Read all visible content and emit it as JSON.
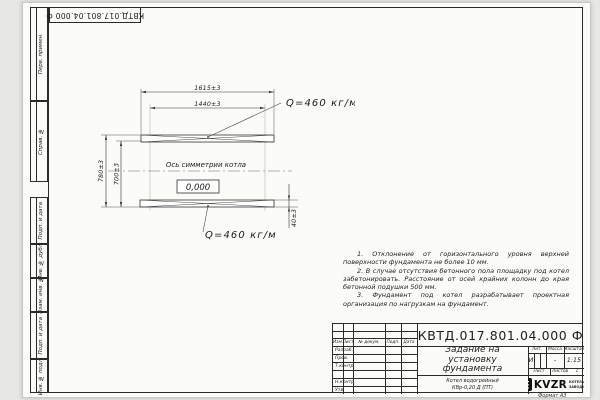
{
  "doc_number": "КВТД.017.801.04.000 Ф",
  "format_label": "Формат А3",
  "colors": {
    "line": "#2b2b2b",
    "sheet": "#fbfbf8",
    "canvas": "#e7e7e4",
    "logo_black": "#101010"
  },
  "margin": {
    "perv_primen": "Перв. примен.",
    "sprav_no": "Справ. №",
    "podp_data_1": "Подп. и дата",
    "inv_dubl": "Инв. № дубл.",
    "vzam_inv": "Взам. инв. №",
    "podp_data_2": "Подп. и дата",
    "inv_podl": "Инв. № подл."
  },
  "drawing": {
    "dim_1615": "1615±3",
    "dim_1440": "1440±3",
    "dim_780": "780±3",
    "dim_700": "700±3",
    "dim_40": "40±3",
    "load_top": "Q=460 кг/м",
    "load_bottom": "Q=460 кг/м",
    "axis_label": "Ось симметрии котла",
    "elevation": "0,000"
  },
  "notes": [
    "1. Отклонение от горизонтального уровня верхней поверхности фундамента не более 10 мм.",
    "2. В случае отсутствия бетонного пола площадку под котел забетонировать. Расстояние от осей крайних колонн до края бетонной подушки 500 мм.",
    "3. Фундамент под котел разрабатывает проектная организация по нагрузкам на фундамент."
  ],
  "title_block": {
    "title_line1": "Задание на",
    "title_line2": "установку",
    "title_line3": "фундамента",
    "header_izm": "Изм.",
    "header_list": "Лист",
    "header_doc": "№ докум.",
    "header_podp": "Подп.",
    "header_data": "Дата",
    "row_razrab": "Разраб.",
    "row_prov": "Пров.",
    "row_tkontr": "Т.контр.",
    "row_nkontr": "Н.контр.",
    "row_utv": "Утв.",
    "lit_label": "Лит.",
    "lit_value": "И",
    "massa_label": "Масса",
    "massa_value": "-",
    "masshtab_label": "Масштаб",
    "masshtab_value": "1:15",
    "list_label": "Лист",
    "listov_label": "Листов",
    "listov_value": "1",
    "product_line1": "Котел водогрейный",
    "product_line2": "КВр-0,20 Д (ПТ)",
    "logo_text": "KVZR",
    "logo_sub1": "КОТЕЛЬНЫЙ",
    "logo_sub2": "ЗАВОД РЭП"
  }
}
